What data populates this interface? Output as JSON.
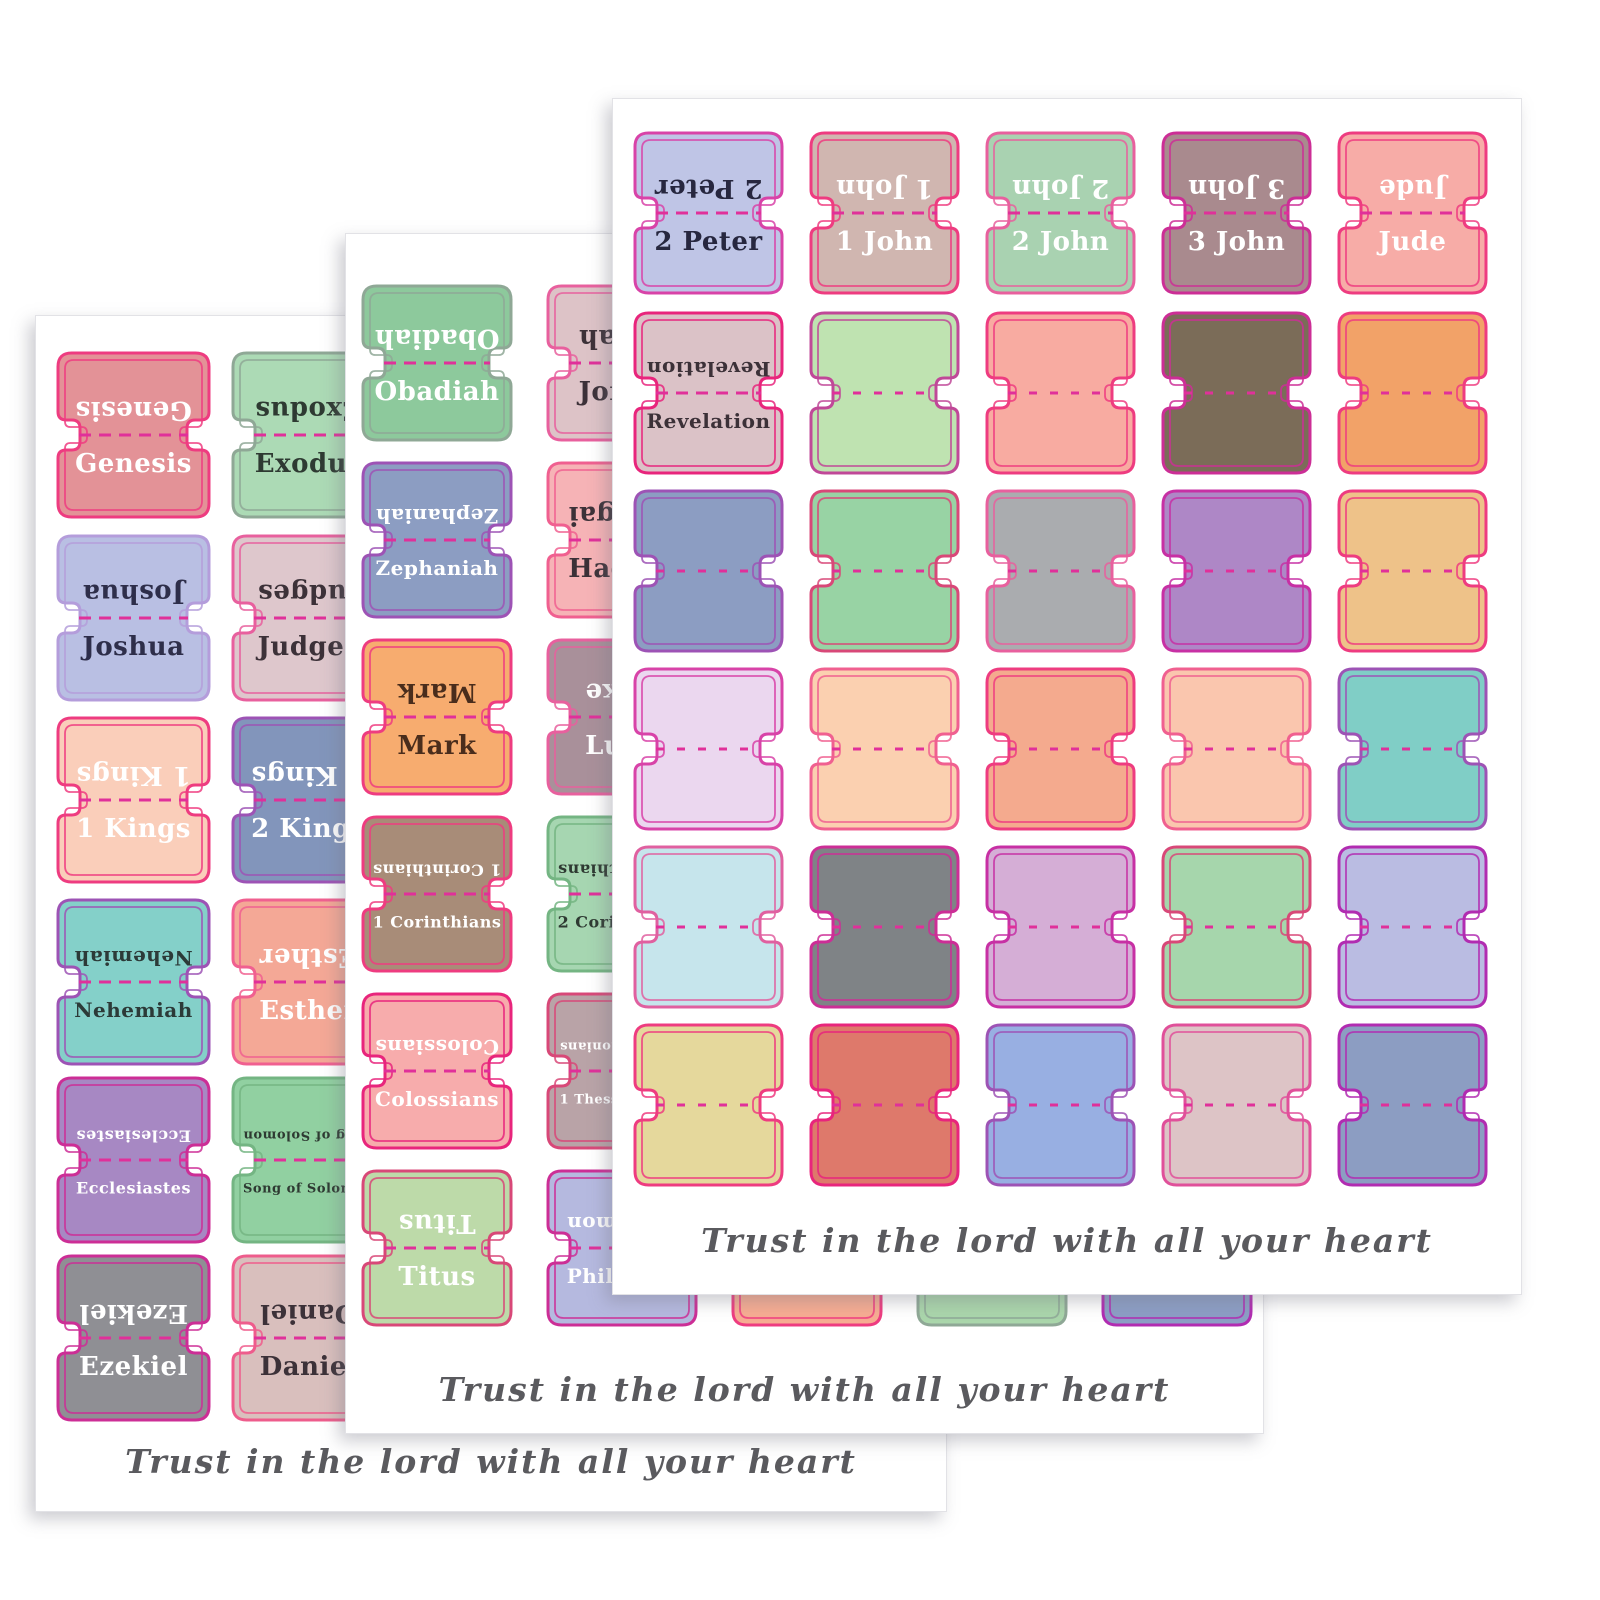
{
  "verse": "Trust in the lord with all your heart",
  "fold_line_color": "#e0309a",
  "sheets": [
    {
      "id": "back",
      "name": "old-testament-sheet",
      "tabs": [
        {
          "row": 0,
          "col": 0,
          "label": "Genesis",
          "fill": "#e39297",
          "stroke": "#ee3c80",
          "text": "#ffffff"
        },
        {
          "row": 0,
          "col": 1,
          "label": "Exodus",
          "fill": "#acdab5",
          "stroke": "#8fa896",
          "text": "#2e3a32"
        },
        {
          "row": 1,
          "col": 0,
          "label": "Joshua",
          "fill": "#b9bfe3",
          "stroke": "#b49ddb",
          "text": "#2e2e4a"
        },
        {
          "row": 1,
          "col": 1,
          "label": "Judges",
          "fill": "#dec7cc",
          "stroke": "#e8609e",
          "text": "#3c3138"
        },
        {
          "row": 2,
          "col": 0,
          "label": "1 Kings",
          "fill": "#faceba",
          "stroke": "#ee3c80",
          "text": "#ffffff"
        },
        {
          "row": 2,
          "col": 1,
          "label": "2 Kings",
          "fill": "#8295bb",
          "stroke": "#9d53b5",
          "text": "#ffffff"
        },
        {
          "row": 3,
          "col": 0,
          "label": "Nehemiah",
          "fill": "#84d0c9",
          "stroke": "#9d53b5",
          "text": "#2c3a38"
        },
        {
          "row": 3,
          "col": 1,
          "label": "Esther",
          "fill": "#f4a896",
          "stroke": "#f06090",
          "text": "#ffffff"
        },
        {
          "row": 4,
          "col": 0,
          "label": "Ecclesiastes",
          "fill": "#a788c3",
          "stroke": "#cc2e96",
          "text": "#ffffff"
        },
        {
          "row": 4,
          "col": 1,
          "label": "Song of Solomon",
          "fill": "#91d0a1",
          "stroke": "#74b583",
          "text": "#2e3a32"
        },
        {
          "row": 5,
          "col": 0,
          "label": "Ezekiel",
          "fill": "#8f8f94",
          "stroke": "#cc2e96",
          "text": "#ffffff"
        },
        {
          "row": 5,
          "col": 1,
          "label": "Daniel",
          "fill": "#d9bfbd",
          "stroke": "#ee5c8c",
          "text": "#3c3138"
        }
      ]
    },
    {
      "id": "middle",
      "name": "prophets-gospels-epistles-sheet",
      "tabs": [
        {
          "row": 0,
          "col": 0,
          "label": "Obadiah",
          "fill": "#8dc99c",
          "stroke": "#8fa896",
          "text": "#ffffff"
        },
        {
          "row": 0,
          "col": 1,
          "label": "Jonah",
          "fill": "#ddc3c7",
          "stroke": "#e8609e",
          "text": "#3c3138",
          "partially_visible": true
        },
        {
          "row": 1,
          "col": 0,
          "label": "Zephaniah",
          "fill": "#8c9dc2",
          "stroke": "#9d53b5",
          "text": "#ffffff"
        },
        {
          "row": 1,
          "col": 1,
          "label": "Haggai",
          "fill": "#f6b3b6",
          "stroke": "#f06090",
          "text": "#3c3138",
          "partially_visible": true
        },
        {
          "row": 2,
          "col": 0,
          "label": "Mark",
          "fill": "#f7ac6f",
          "stroke": "#ee3c80",
          "text": "#4a2d1c"
        },
        {
          "row": 2,
          "col": 1,
          "label": "Luke",
          "fill": "#a9909a",
          "stroke": "#e8609e",
          "text": "#ffffff",
          "partially_visible": true
        },
        {
          "row": 3,
          "col": 0,
          "label": "1 Corinthians",
          "fill": "#a88c78",
          "stroke": "#ee3c80",
          "text": "#ffffff"
        },
        {
          "row": 3,
          "col": 1,
          "label": "2 Corinthians",
          "fill": "#a6d6b1",
          "stroke": "#74b583",
          "text": "#2e3a32",
          "partially_visible": true
        },
        {
          "row": 4,
          "col": 0,
          "label": "Colossians",
          "fill": "#f7acac",
          "stroke": "#e8257c",
          "text": "#ffffff"
        },
        {
          "row": 4,
          "col": 1,
          "label": "1 Thessalonians",
          "fill": "#b9a3a7",
          "stroke": "#d84878",
          "text": "#ffffff",
          "partially_visible": true
        },
        {
          "row": 5,
          "col": 0,
          "label": "Titus",
          "fill": "#bddaa9",
          "stroke": "#d84878",
          "text": "#ffffff"
        },
        {
          "row": 5,
          "col": 1,
          "label": "Philemon",
          "fill": "#b5b9df",
          "stroke": "#cc2e96",
          "text": "#ffffff",
          "partially_visible": true
        },
        {
          "row": 5,
          "col": 2,
          "label": "",
          "fill": "#f7ac92",
          "stroke": "#ee3c80",
          "text": "#3c3138",
          "partially_visible": true
        },
        {
          "row": 5,
          "col": 3,
          "label": "",
          "fill": "#aad6ab",
          "stroke": "#8fa896",
          "text": "#3c3138",
          "partially_visible": true
        },
        {
          "row": 5,
          "col": 4,
          "label": "",
          "fill": "#8c9ec5",
          "stroke": "#b12cb1",
          "text": "#3c3138",
          "partially_visible": true
        }
      ]
    },
    {
      "id": "front",
      "name": "new-testament-sheet",
      "tabs": [
        {
          "row": 0,
          "col": 0,
          "label": "2 Peter",
          "fill": "#bfc5e6",
          "stroke": "#d843a8",
          "text": "#27273f"
        },
        {
          "row": 0,
          "col": 1,
          "label": "1 John",
          "fill": "#d0b6b0",
          "stroke": "#ee3c80",
          "text": "#ffffff"
        },
        {
          "row": 0,
          "col": 2,
          "label": "2 John",
          "fill": "#a9d2b1",
          "stroke": "#e8609e",
          "text": "#ffffff"
        },
        {
          "row": 0,
          "col": 3,
          "label": "3 John",
          "fill": "#a98a8e",
          "stroke": "#cc2e96",
          "text": "#ffffff"
        },
        {
          "row": 0,
          "col": 4,
          "label": "Jude",
          "fill": "#f7aca7",
          "stroke": "#ee3c80",
          "text": "#ffffff"
        },
        {
          "row": 1,
          "col": 0,
          "label": "Revelation",
          "fill": "#dbc2c7",
          "stroke": "#e8257c",
          "text": "#3c3138"
        },
        {
          "row": 1,
          "col": 1,
          "label": "",
          "fill": "#bfe3b1",
          "stroke": "#c04898",
          "text": "#3c3138"
        },
        {
          "row": 1,
          "col": 2,
          "label": "",
          "fill": "#f8aba1",
          "stroke": "#ee3c80",
          "text": "#3c3138"
        },
        {
          "row": 1,
          "col": 3,
          "label": "",
          "fill": "#7b6c58",
          "stroke": "#cc2e96",
          "text": "#ffffff"
        },
        {
          "row": 1,
          "col": 4,
          "label": "",
          "fill": "#f2a268",
          "stroke": "#ee3c80",
          "text": "#3c3138"
        },
        {
          "row": 2,
          "col": 0,
          "label": "",
          "fill": "#8c9dc2",
          "stroke": "#9d53b5",
          "text": "#ffffff"
        },
        {
          "row": 2,
          "col": 1,
          "label": "",
          "fill": "#98d3a4",
          "stroke": "#d84878",
          "text": "#3c3138"
        },
        {
          "row": 2,
          "col": 2,
          "label": "",
          "fill": "#aaacaf",
          "stroke": "#e8609e",
          "text": "#3c3138"
        },
        {
          "row": 2,
          "col": 3,
          "label": "",
          "fill": "#ae87c6",
          "stroke": "#c730a4",
          "text": "#ffffff"
        },
        {
          "row": 2,
          "col": 4,
          "label": "",
          "fill": "#eec289",
          "stroke": "#ee3c80",
          "text": "#3c3138"
        },
        {
          "row": 3,
          "col": 0,
          "label": "",
          "fill": "#ebd7ef",
          "stroke": "#d843a8",
          "text": "#3c3138"
        },
        {
          "row": 3,
          "col": 1,
          "label": "",
          "fill": "#fbd0b0",
          "stroke": "#f06090",
          "text": "#3c3138"
        },
        {
          "row": 3,
          "col": 2,
          "label": "",
          "fill": "#f4aa8e",
          "stroke": "#ee3c80",
          "text": "#3c3138"
        },
        {
          "row": 3,
          "col": 3,
          "label": "",
          "fill": "#fac6ae",
          "stroke": "#f06090",
          "text": "#3c3138"
        },
        {
          "row": 3,
          "col": 4,
          "label": "",
          "fill": "#80cec6",
          "stroke": "#9d53b5",
          "text": "#3c3138"
        },
        {
          "row": 4,
          "col": 0,
          "label": "",
          "fill": "#c6e5ec",
          "stroke": "#e060a0",
          "text": "#3c3138"
        },
        {
          "row": 4,
          "col": 1,
          "label": "",
          "fill": "#7f8386",
          "stroke": "#cc2e96",
          "text": "#ffffff"
        },
        {
          "row": 4,
          "col": 2,
          "label": "",
          "fill": "#d5aed6",
          "stroke": "#c730a4",
          "text": "#3c3138"
        },
        {
          "row": 4,
          "col": 3,
          "label": "",
          "fill": "#a6d6ac",
          "stroke": "#d84878",
          "text": "#3c3138"
        },
        {
          "row": 4,
          "col": 4,
          "label": "",
          "fill": "#babce2",
          "stroke": "#b12cb1",
          "text": "#3c3138"
        },
        {
          "row": 5,
          "col": 0,
          "label": "",
          "fill": "#e5d89c",
          "stroke": "#ee3c80",
          "text": "#3c3138"
        },
        {
          "row": 5,
          "col": 1,
          "label": "",
          "fill": "#de796b",
          "stroke": "#e8257c",
          "text": "#ffffff"
        },
        {
          "row": 5,
          "col": 2,
          "label": "",
          "fill": "#98afe2",
          "stroke": "#9d53b5",
          "text": "#3c3138"
        },
        {
          "row": 5,
          "col": 3,
          "label": "",
          "fill": "#ddc4c6",
          "stroke": "#e0509a",
          "text": "#3c3138"
        },
        {
          "row": 5,
          "col": 4,
          "label": "",
          "fill": "#8c9dc2",
          "stroke": "#b12cb1",
          "text": "#3c3138"
        }
      ]
    }
  ]
}
